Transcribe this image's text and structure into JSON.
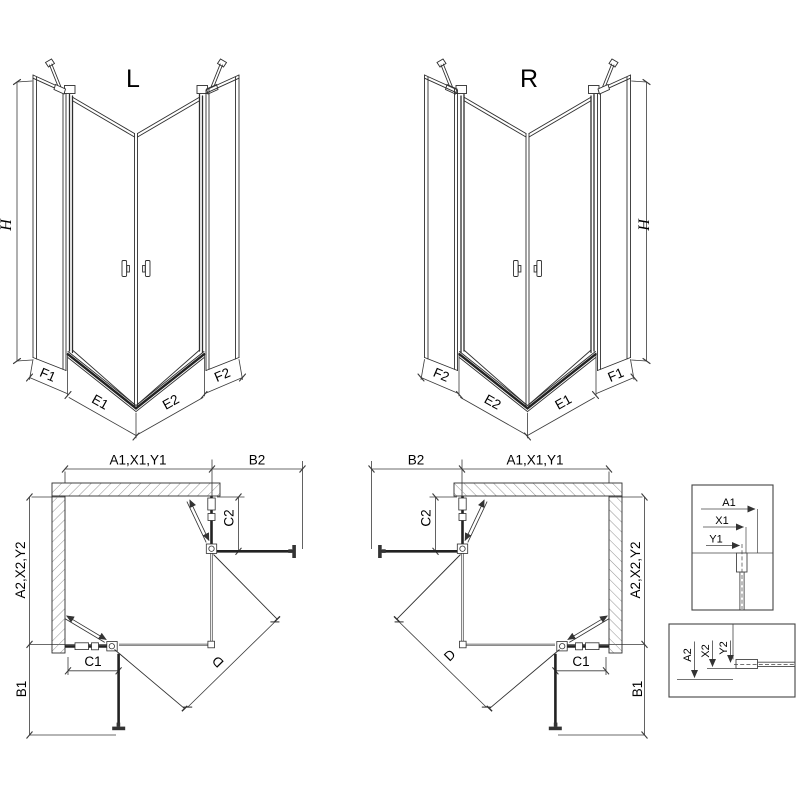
{
  "iso": {
    "left_label": "L",
    "right_label": "R",
    "height": "H",
    "f1": "F1",
    "e1": "E1",
    "e2": "E2",
    "f2": "F2"
  },
  "plan": {
    "width_top": "A1,X1,Y1",
    "return_top": "B2",
    "depth_side": "A2,X2,Y2",
    "fixed_top": "C2",
    "fixed_bottom": "C1",
    "return_bottom": "B1",
    "diagonal": "D"
  },
  "detail_top": {
    "a1": "A1",
    "x1": "X1",
    "y1": "Y1"
  },
  "detail_bottom": {
    "a2": "A2",
    "x2": "X2",
    "y2": "Y2"
  },
  "colors": {
    "background": "#ffffff",
    "line": "#2f2f2f",
    "text": "#000000"
  }
}
